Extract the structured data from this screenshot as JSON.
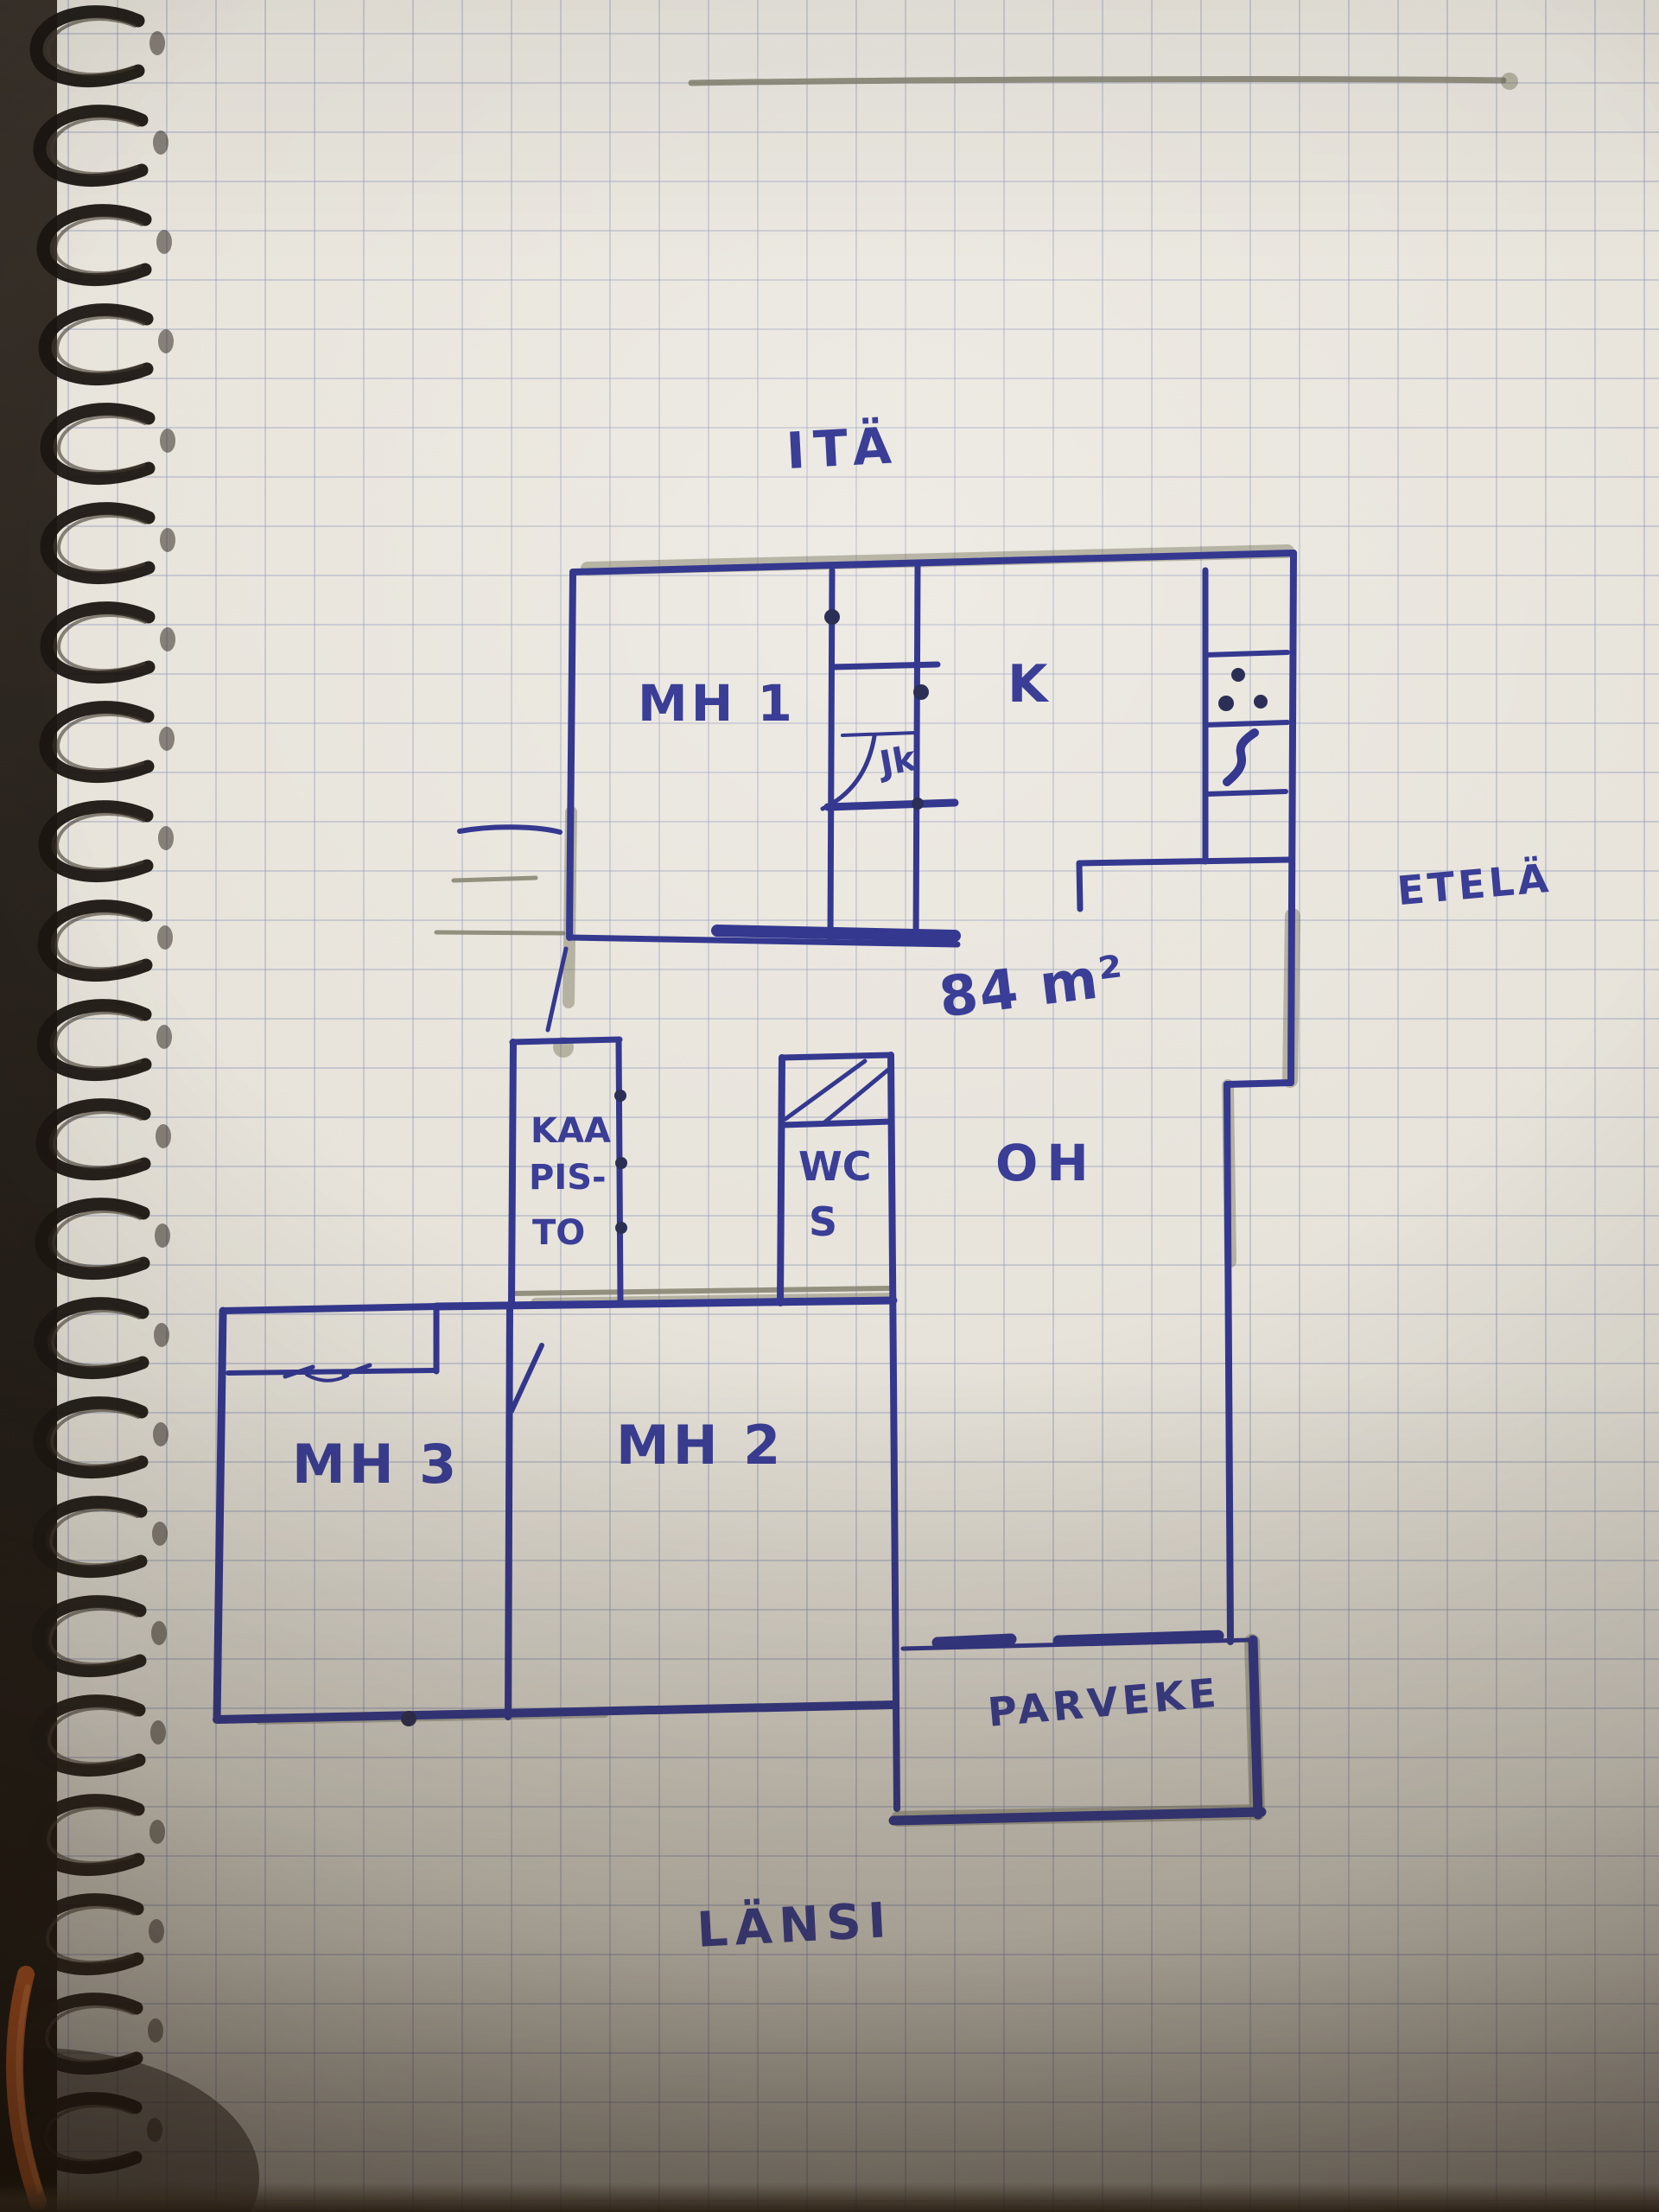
{
  "compass": {
    "east_label": "ITÄ",
    "south_label": "ETELÄ",
    "west_label": "LÄNSI"
  },
  "floor_plan": {
    "area_label": "84 m²",
    "rooms": {
      "mh1": "MH 1",
      "kitchen": "K",
      "stair_closet": "Jk",
      "closet_line1": "KAA",
      "closet_line2": "PIS-",
      "closet_line3": "TO",
      "wc_line1": "WC",
      "wc_line2": "S",
      "living_room": "OH",
      "mh2": "MH 2",
      "mh3": "MH 3",
      "balcony": "PARVEKE"
    }
  },
  "colors": {
    "ink": "#34388f",
    "ink_text": "#3a3e96",
    "ink_dark": "#2c2f55",
    "pencil": "#84816f",
    "smudge": "#6e6b50",
    "coil": "#1b1612",
    "orange_pen": "#cc5a21",
    "paper": "#e7e4dd",
    "grid": "#808ab0"
  }
}
